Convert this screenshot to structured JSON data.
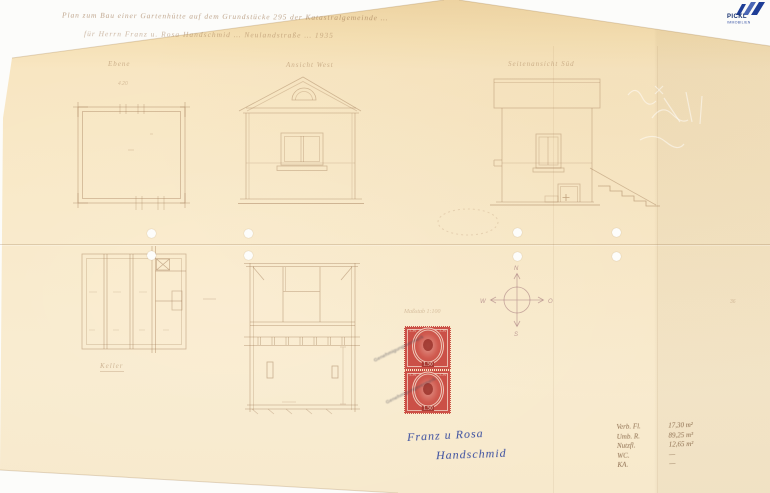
{
  "colors": {
    "paper": "#f8e7c3",
    "pencil": "#9c7450",
    "ink": "#3b4fa0",
    "stamp_red": "#cb5047",
    "logo_blue": "#1e3d96"
  },
  "logo": {
    "brand": "PICKL",
    "subtitle": "IMMOBILIEN"
  },
  "title": {
    "line1": "Plan zum Bau einer Gartenhütte auf dem Grundstücke 295 der Katastralgemeinde …",
    "line2": "für Herrn Franz u. Rosa Handschmid … Neulandstraße … 1935"
  },
  "drawings": {
    "plan_top": {
      "label": "Ebene",
      "dim": "4.20"
    },
    "front_elevation": {
      "label": "Ansicht West"
    },
    "side_elevation": {
      "label": "Seitenansicht Süd"
    },
    "cellar_plan": {
      "label": "Keller"
    },
    "section": {
      "scale_note": "Maßstab 1:100"
    },
    "compass": {
      "n": "N",
      "s": "S",
      "e": "O",
      "w": "W"
    }
  },
  "stamps": {
    "value": "1.50",
    "corner_value": "1.50",
    "overprint_line1": "Genehmigungsvermerk",
    "overprint_line2": "Genehmigungsvermerk"
  },
  "signature": {
    "line1": "Franz u Rosa",
    "line2": "Handschmid"
  },
  "stats_table": {
    "rows": [
      {
        "label": "Verb. Fl.",
        "value": "17,30 m²"
      },
      {
        "label": "Umb. R.",
        "value": "89,25 m³"
      },
      {
        "label": "Nutzfl.",
        "value": "12,65 m²"
      },
      {
        "label": "WC.",
        "value": "—"
      },
      {
        "label": "KA.",
        "value": "—"
      }
    ]
  },
  "misc": {
    "right_edge_mark": "36"
  }
}
